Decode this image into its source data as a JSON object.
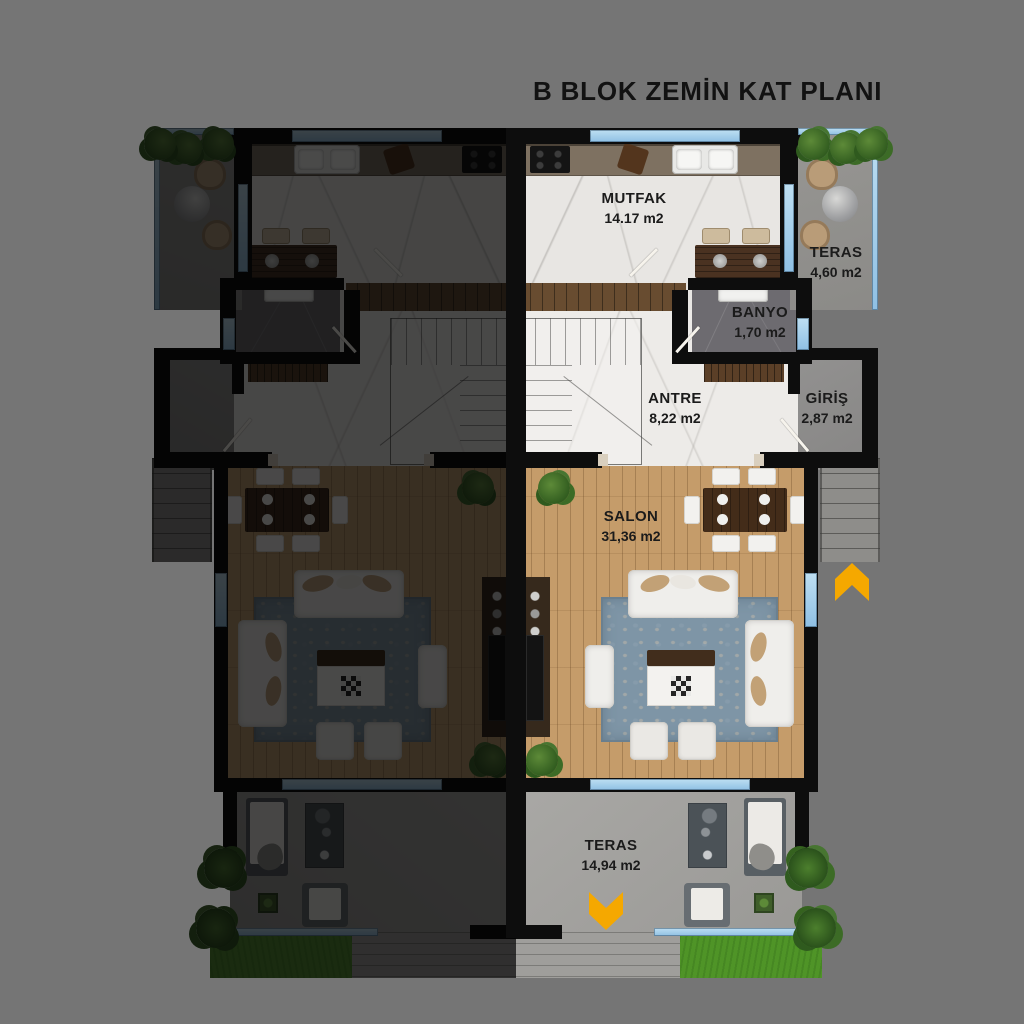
{
  "title": "B BLOK ZEMİN KAT PLANI",
  "rooms": {
    "mutfak": {
      "label": "MUTFAK",
      "area": "14.17 m2"
    },
    "teras_ust": {
      "label": "TERAS",
      "area": "4,60 m2"
    },
    "banyo": {
      "label": "BANYO",
      "area": "1,70 m2"
    },
    "antre": {
      "label": "ANTRE",
      "area": "8,22 m2"
    },
    "giris": {
      "label": "GİRİŞ",
      "area": "2,87 m2"
    },
    "salon": {
      "label": "SALON",
      "area": "31,36 m2"
    },
    "teras_alt": {
      "label": "TERAS",
      "area": "14,94 m2"
    }
  },
  "icons": {
    "entrance_arrow": "chevron-up-icon",
    "terrace_arrow": "chevron-down-icon"
  },
  "colors": {
    "background": "#757575",
    "wall": "#0d0d0d",
    "window": "#8fc0e4",
    "arrow": "#F5A800",
    "wood_floor": "#c59c6a",
    "grass": "#4f9427",
    "rug": "#7e95a6"
  }
}
